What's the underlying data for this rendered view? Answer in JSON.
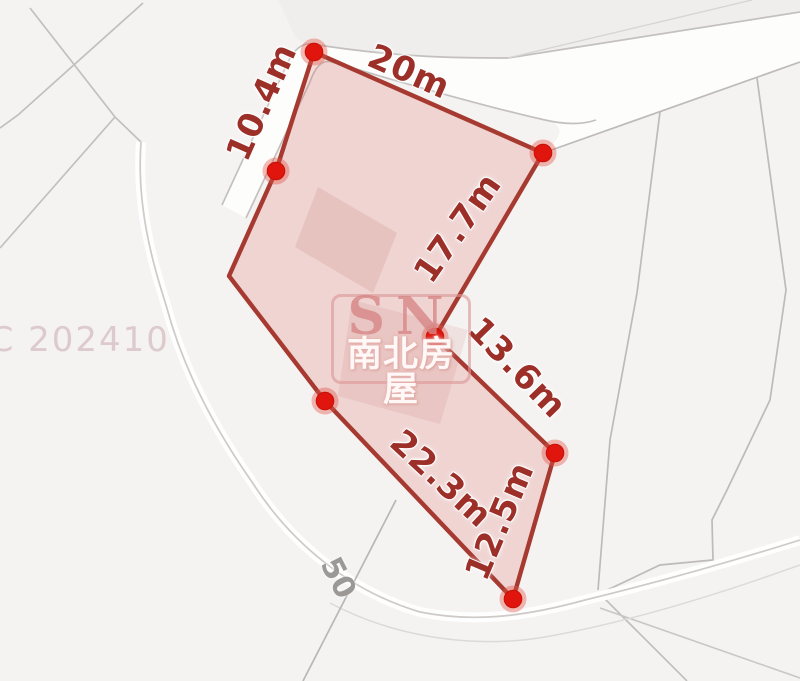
{
  "title": "Cadastral parcel map with edge measurements",
  "parcel": {
    "measurements": [
      "10.4m",
      "20m",
      "17.7m",
      "13.6m",
      "22.3m",
      "12.5m"
    ],
    "vertex_count": 7
  },
  "map_labels": {
    "road_number": "50",
    "reference_code": "SC 202410"
  },
  "watermark": {
    "initials": "SN",
    "company_name": "南北房屋"
  },
  "colors": {
    "background": "#f5f3f2",
    "parcel_outline": "#a63a30",
    "parcel_fill": "#f3d9d4",
    "vertex_dot": "#e0150d",
    "measurement_text": "#9c2f28",
    "cadastral_line": "#c2bfbe",
    "road_number_text": "#9b9896",
    "reference_code_text": "#dccacc",
    "watermark_pink": "#d68686"
  }
}
